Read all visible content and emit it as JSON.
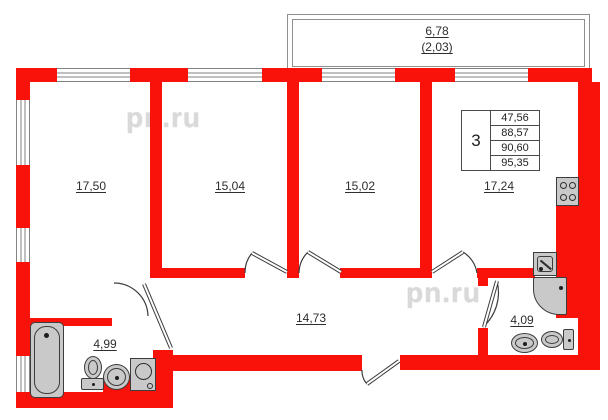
{
  "plan": {
    "watermark": "pn.ru",
    "balcony": {
      "length": "6,78",
      "width": "(2,03)"
    },
    "rooms": [
      {
        "id": "living-room-1",
        "area": "17,50"
      },
      {
        "id": "living-room-2",
        "area": "15,04"
      },
      {
        "id": "living-room-3",
        "area": "15,02"
      },
      {
        "id": "kitchen",
        "area": "17,24"
      },
      {
        "id": "hallway",
        "area": "14,73"
      },
      {
        "id": "bathroom",
        "area": "4,99"
      },
      {
        "id": "wc",
        "area": "4,09"
      }
    ],
    "info_table": {
      "room_count": "3",
      "areas": [
        "47,56",
        "88,57",
        "90,60",
        "95,35"
      ]
    },
    "icons": [
      "bathtub-icon",
      "toilet-icon",
      "sink-icon",
      "washing-machine-icon",
      "stove-icon",
      "kitchen-sink-icon",
      "shower-icon"
    ],
    "colors": {
      "wall": "#f8120a",
      "fixture_fill": "#c9c9c9",
      "line": "#3c3c3c",
      "watermark": "#d9d9d9"
    }
  }
}
